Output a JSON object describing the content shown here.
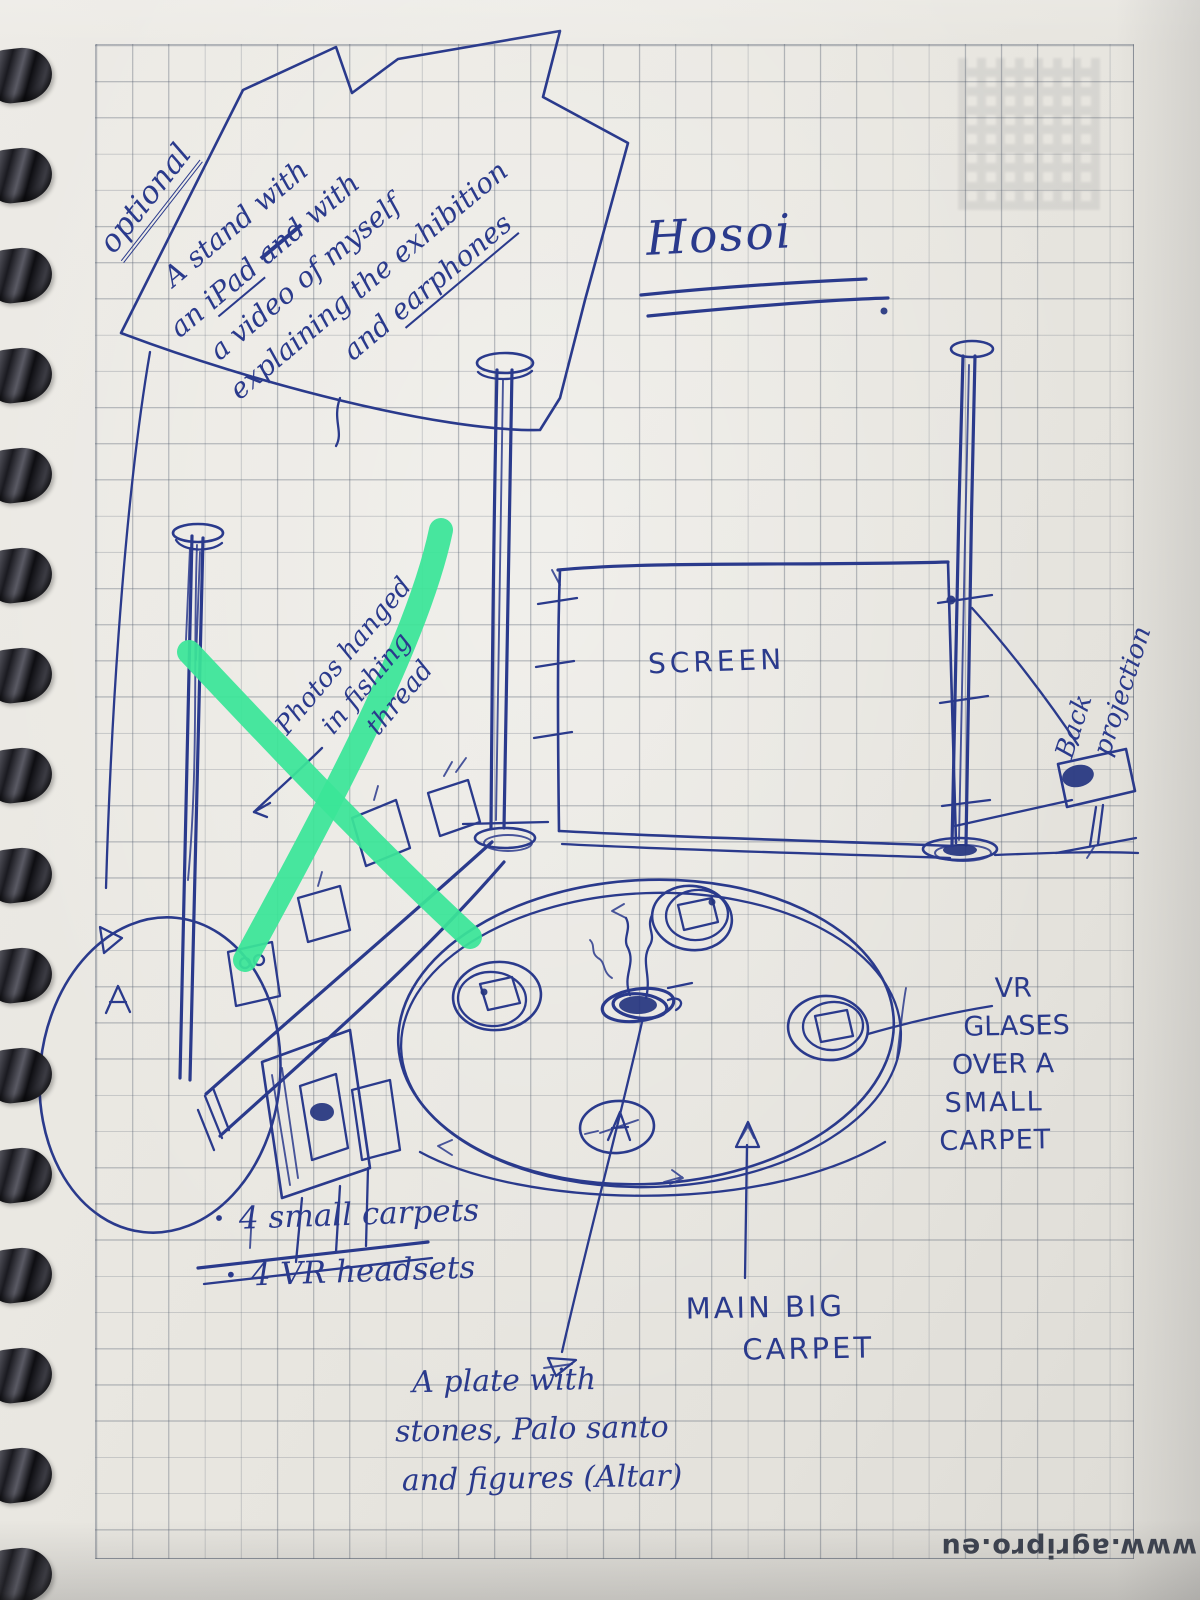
{
  "notebook": {
    "optional_label": "optional",
    "stand_note": {
      "line1": "A stand with",
      "line2_pre": "an ",
      "line2_ipad": "iPad",
      "line2_struck": "and",
      "line2_post": " with",
      "line3": "a video of myself",
      "line4": "explaining the exhibition",
      "line5_pre": "and ",
      "line5_earphones": "earphones"
    },
    "title": "Hosoi",
    "photos_note": {
      "line1": "Photos hanged",
      "line2": "in fishing",
      "line3": "thread"
    },
    "screen_label": "SCREEN",
    "back_projection_note": {
      "line1": "Back",
      "line2": "projection"
    },
    "vr_note": {
      "line1": "VR",
      "line2": "GLASES",
      "line3": "OVER A",
      "line4": "SMALL",
      "line5": "CARPET"
    },
    "bullets": [
      {
        "bullet": "•",
        "text": "4 small carpets"
      },
      {
        "bullet": "•",
        "text": "4 VR headsets"
      }
    ],
    "main_carpet_label": {
      "line1": "MAIN BIG",
      "line2": "CARPET"
    },
    "altar_note": {
      "line1": "A plate with",
      "line2": "stones, Palo santo",
      "line3": "and figures (Altar)"
    },
    "watermark": "www.agripro.eu",
    "colors": {
      "ink": "#2a3a8c",
      "highlight_green": "#3ae598",
      "paper": "#e9e7e1"
    }
  }
}
